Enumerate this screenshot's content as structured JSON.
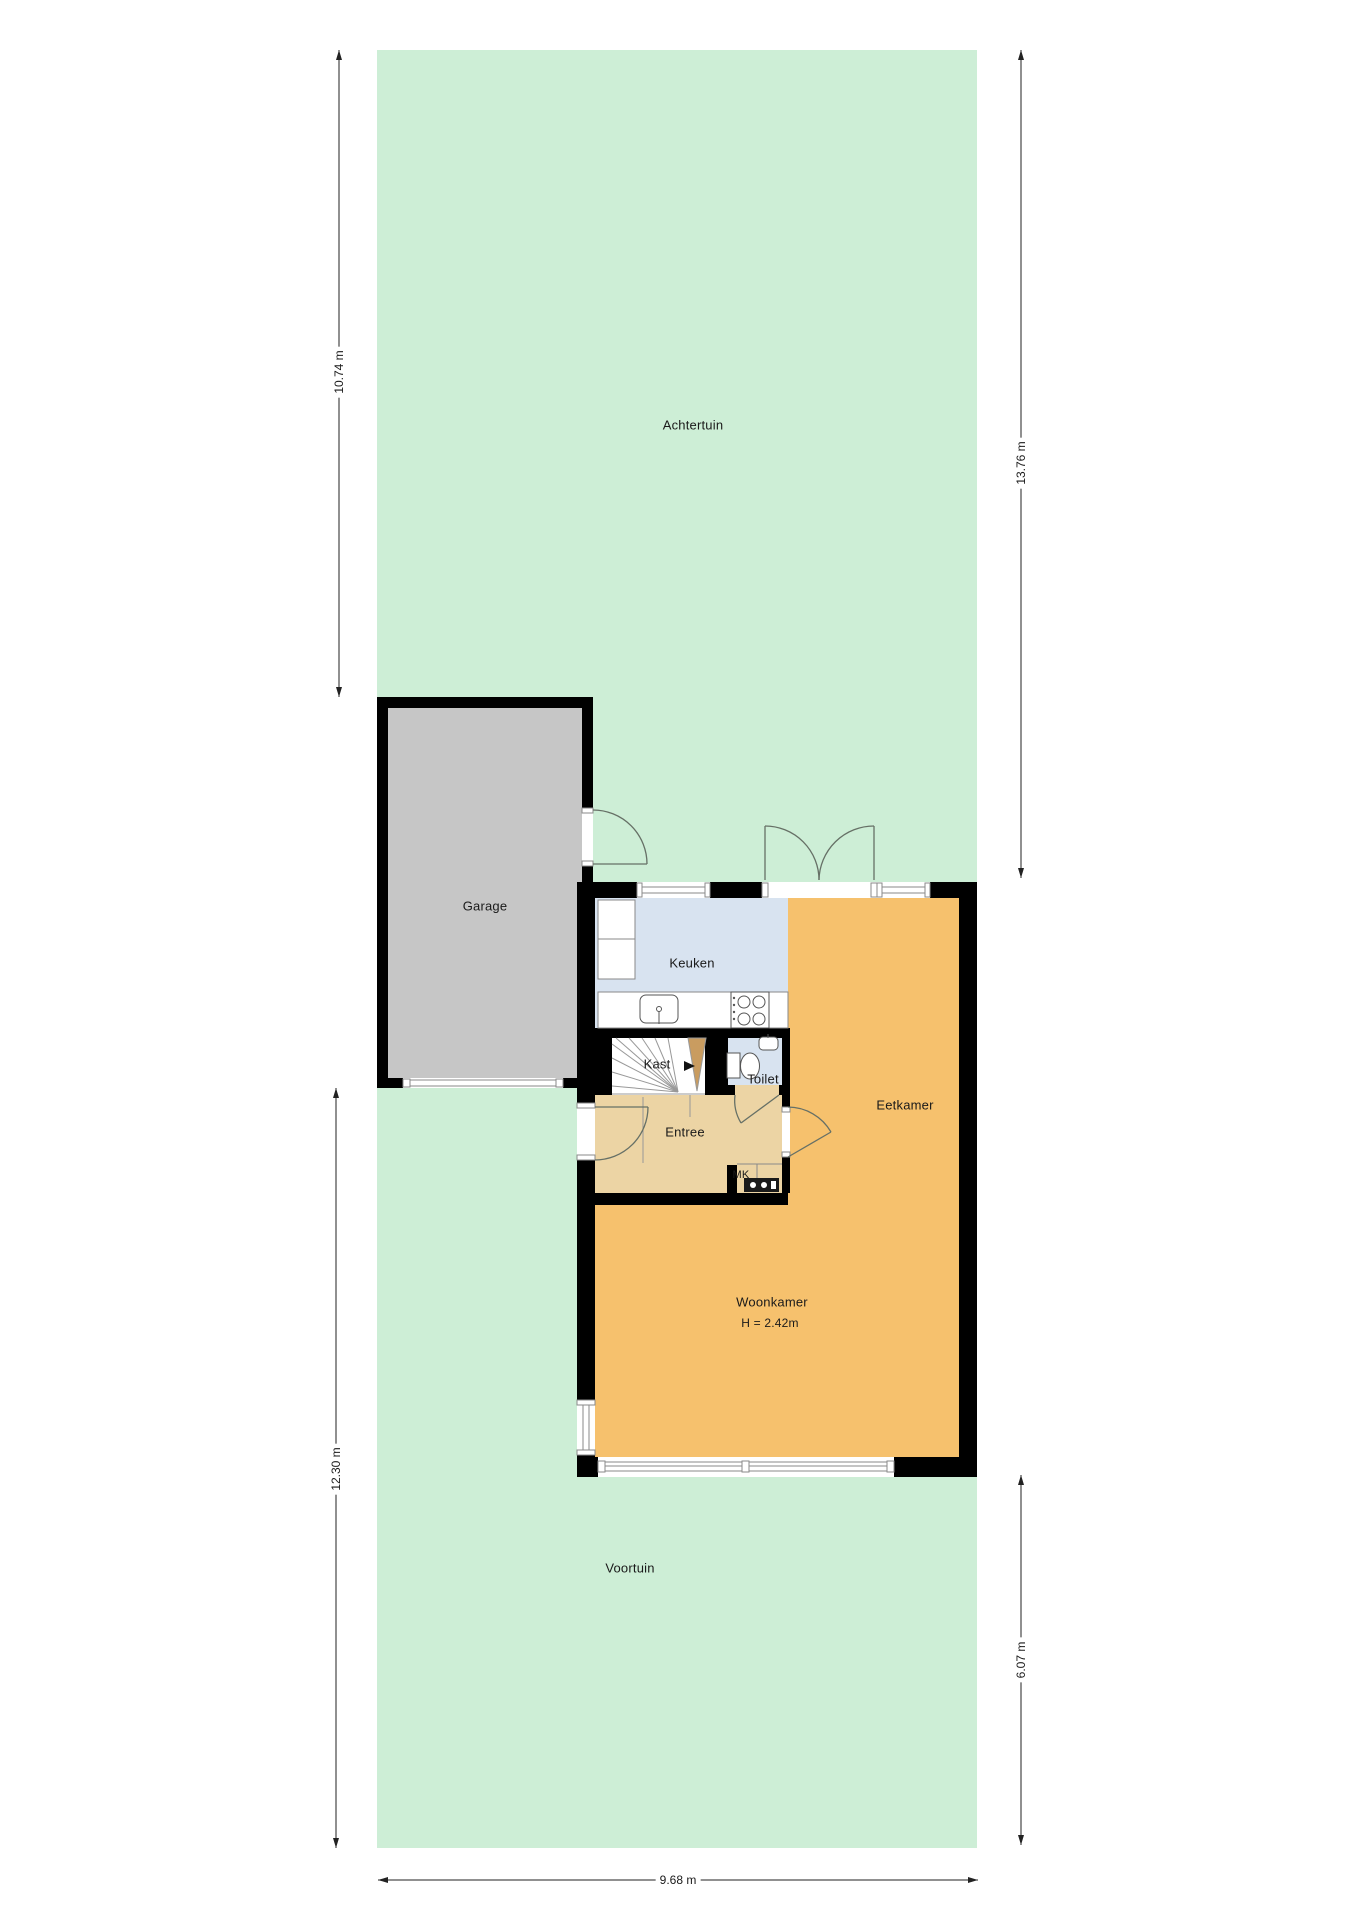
{
  "plan": {
    "rooms": {
      "achtertuin": "Achtertuin",
      "garage": "Garage",
      "keuken": "Keuken",
      "eetkamer": "Eetkamer",
      "kast": "Kast",
      "toilet": "Toilet",
      "entree": "Entree",
      "mk": "MK",
      "woonkamer": "Woonkamer",
      "woonkamer_height": "H = 2.42m",
      "voortuin": "Voortuin"
    },
    "dimensions": {
      "left_top": "10.74 m",
      "left_bottom": "12.30 m",
      "right_top": "13.76 m",
      "right_bottom": "6.07 m",
      "bottom": "9.68 m"
    },
    "colors": {
      "garden": "#cdeed6",
      "garage_floor": "#c6c6c6",
      "kitchen_toilet_floor": "#d8e3f0",
      "living_dining_floor": "#f6c16d",
      "hall_floor": "#ecd4a4",
      "stair_wedge": "#c99c60",
      "walls": "#000000",
      "background": "#ffffff"
    }
  }
}
